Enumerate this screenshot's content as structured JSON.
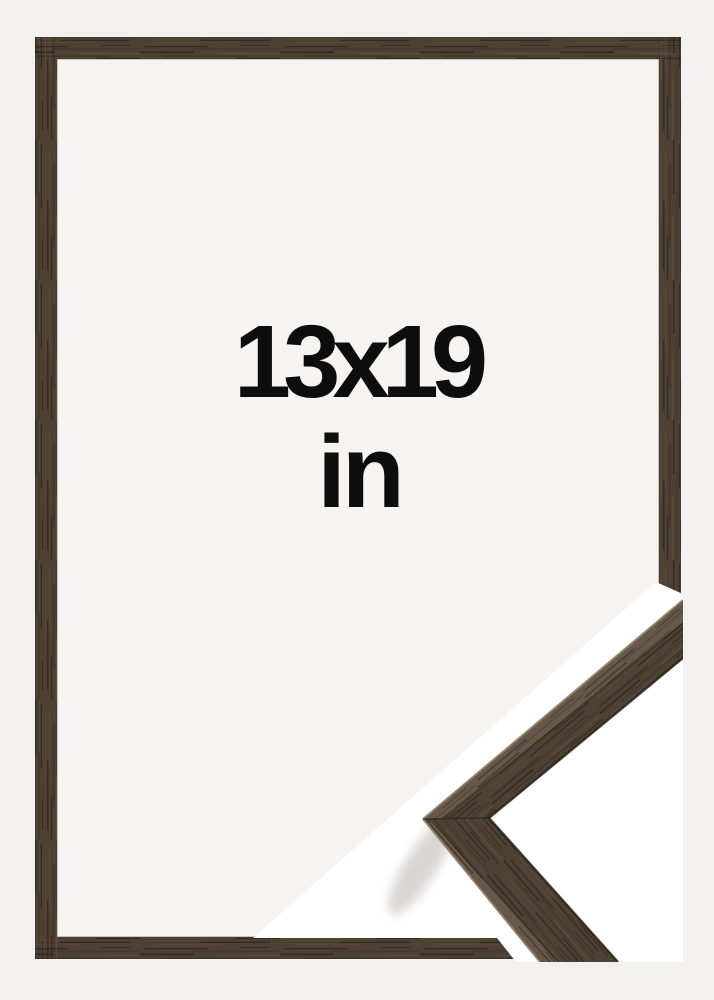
{
  "product_image": {
    "type": "picture-frame-size-mockup",
    "size_label_line1": "13x19",
    "size_label_line2": "in"
  },
  "colors": {
    "background": "#f2f1ef",
    "frame_interior": "#f5f4f2",
    "wood_base": "#4d4134",
    "wood_top_face": "#665848",
    "wood_edge_dark": "#292116",
    "wood_edge_highlight": "#8f7f69",
    "sample_backdrop": "#ffffff",
    "text": "#0d0d0d",
    "shadow": "#b9b4ae"
  }
}
